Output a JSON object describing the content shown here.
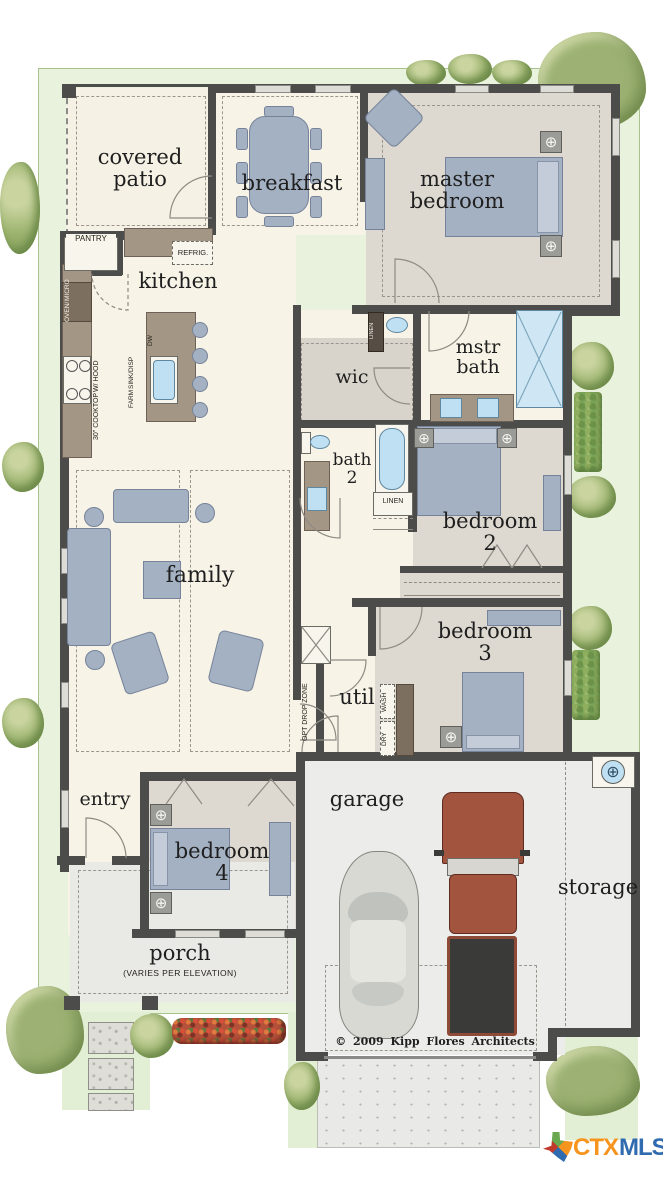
{
  "rooms": {
    "covered_patio": {
      "l1": "covered",
      "l2": "patio"
    },
    "breakfast": {
      "l1": "breakfast"
    },
    "master_bedroom": {
      "l1": "master",
      "l2": "bedroom"
    },
    "kitchen": {
      "l1": "kitchen"
    },
    "wic": {
      "l1": "wic"
    },
    "mstr_bath": {
      "l1": "mstr",
      "l2": "bath"
    },
    "bath_2": {
      "l1": "bath",
      "l2": "2"
    },
    "bedroom_2": {
      "l1": "bedroom",
      "l2": "2"
    },
    "family": {
      "l1": "family"
    },
    "util": {
      "l1": "util"
    },
    "bedroom_3": {
      "l1": "bedroom",
      "l2": "3"
    },
    "entry": {
      "l1": "entry"
    },
    "bedroom_4": {
      "l1": "bedroom",
      "l2": "4"
    },
    "porch": {
      "l1": "porch",
      "note": "(VARIES PER ELEVATION)"
    },
    "garage": {
      "l1": "garage"
    },
    "storage": {
      "l1": "storage"
    }
  },
  "fixtures": {
    "pantry": "PANTRY",
    "refrig": "REFRIG.",
    "oven_micro_1": "OVEN/",
    "oven_micro_2": "MICRO",
    "cooktop_1": "30\" COOKTOP",
    "cooktop_2": "W/ HOOD",
    "farm_sink_1": "FARM",
    "farm_sink_2": "SINK/DISP",
    "dw": "DW",
    "linen_hall": "LINEN",
    "linen_bath": "LINEN",
    "opt_drop_zone": "OPT DROP ZONE",
    "wash": "WASH",
    "dry": "DRY"
  },
  "footer": {
    "copyright": "© 2009  Kipp  Flores  Architects"
  },
  "logo": {
    "ctx": "CTX",
    "mls": "MLS",
    "ctx_color": "#F7941E",
    "mls_color": "#2F6BAE"
  },
  "palette": {
    "wall": "#4c4c4a",
    "floor_cream": "#f7f3e7",
    "floor_gray": "#ddd9d0",
    "counter_tan": "#a39685",
    "furniture_blue": "#a4b1c2",
    "water_blue": "#bfe0f2",
    "lot_green": "#e9f2dc",
    "garage_gray": "#ececea"
  }
}
